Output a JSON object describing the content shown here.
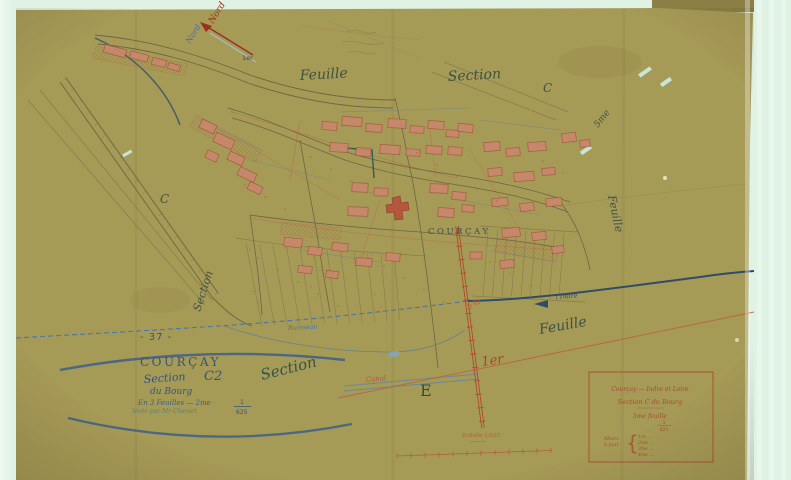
{
  "compass": {
    "north_red": "Nord",
    "north_blue": "Nord",
    "note": "1er"
  },
  "margin_labels": {
    "top_feuille": "Feuille",
    "top_section": "Section",
    "top_c": "C",
    "left_c": "C",
    "left_section": "Section",
    "right_5": "5me",
    "right_feuille": "Feuille",
    "bottom_section": "Section",
    "bottom_feuille": "Feuille",
    "bottom_1er": "1er",
    "bottom_e": "E"
  },
  "water_roads": {
    "ruisseau": "Ruisseau",
    "canal": "Canal",
    "indre": "l'Indre"
  },
  "village": {
    "name": "COURÇAY"
  },
  "cartouche": {
    "number": "- 37 -",
    "title": "COURÇAY",
    "section_word": "Section",
    "section_code": "C2",
    "line2": "du Bourg",
    "line3": "En 3 Feuilles — 2me",
    "line4": "levée par Mr Cheniet",
    "scale_num": "1",
    "scale_den": "625"
  },
  "legend_box": {
    "line1": "Courçay — Indre et Loire",
    "line2": "Section C du Bourg",
    "line3": "5me feuille",
    "scale_num": "1",
    "scale_den": "625",
    "brace_label_1": "Mises",
    "brace_label_2": "à jour",
    "note1": "1re …",
    "note2": "2me …",
    "note3": "3me …",
    "note4": "4me …"
  },
  "scale_bar": {
    "caption": "Echelle 1/625"
  },
  "colors": {
    "paper": "#a69a57",
    "scan_background": "#dff2e3",
    "ink_red": "#a84a32",
    "ink_blue": "#3a5f8a",
    "ink_dark": "#33524a",
    "stream_blue": "#4a76a8",
    "road_dark": "#2e4d66",
    "building": "#c9876d"
  }
}
